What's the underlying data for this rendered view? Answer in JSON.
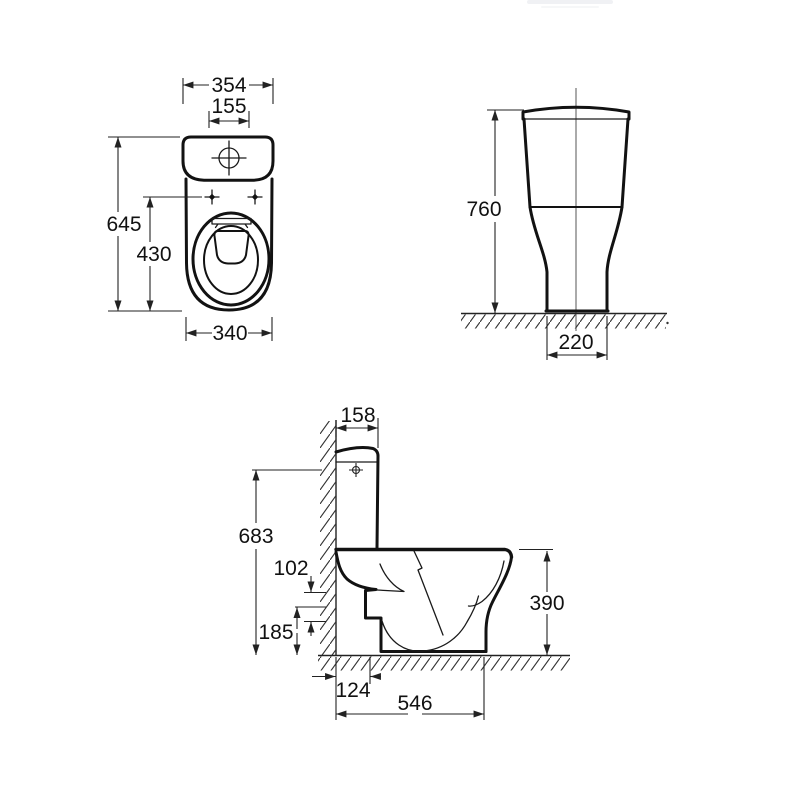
{
  "drawing": {
    "type": "technical-dimension-drawing",
    "subject": "close-coupled toilet with cistern",
    "unit": "mm",
    "views": {
      "plan": {
        "name": "plan view",
        "dims": {
          "cistern_width": "354",
          "flush_button_span": "155",
          "overall_depth": "645",
          "seat_depth": "430",
          "bowl_width": "340"
        }
      },
      "front": {
        "name": "front elevation",
        "dims": {
          "overall_height": "760",
          "base_width": "220"
        }
      },
      "side": {
        "name": "side elevation",
        "dims": {
          "cistern_depth": "158",
          "cistern_top_height": "683",
          "outlet_span": "102",
          "outlet_height": "185",
          "outlet_offset": "124",
          "overall_depth": "546",
          "rim_height": "390"
        }
      }
    }
  }
}
